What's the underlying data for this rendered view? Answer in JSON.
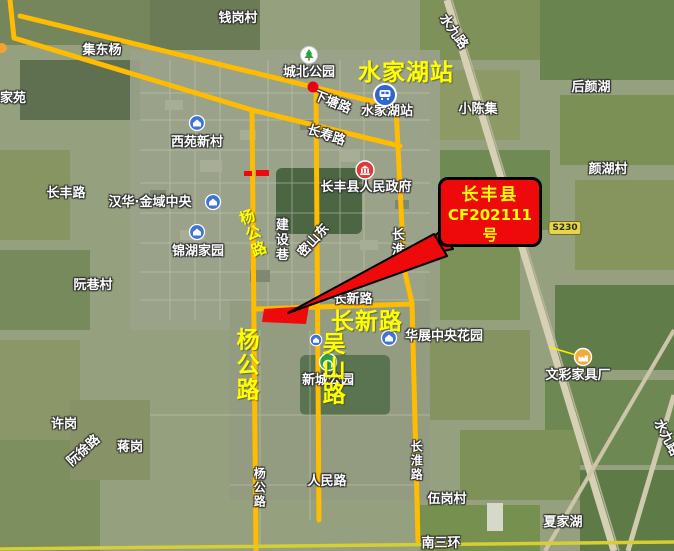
{
  "map": {
    "title": "长丰县 CF202111 号 地块示意图（水家湖卫星图）",
    "colors": {
      "overlay_road": "#ffbc00",
      "ring_road": "#d6ce33",
      "annotation_red": "#ee0a0a",
      "annotation_yellow": "#ffff00",
      "label_white": "#ffffff"
    },
    "overlay_roads": [
      {
        "name": "xiatang-road-overlay",
        "points": "20,16 313,87 396,107",
        "w": 5
      },
      {
        "name": "changshou-road-overlay",
        "points": "10,0 14,38 252,110 400,146",
        "w": 5
      },
      {
        "name": "changhuai-road-overlay",
        "points": "396,107 404,268 412,303 418,541",
        "w": 5
      },
      {
        "name": "yanggong-road-overlay",
        "points": "252,110 256,551",
        "w": 5
      },
      {
        "name": "wushan-road-overlay",
        "points": "316,90 319,520",
        "w": 5
      },
      {
        "name": "changxin-road-overlay",
        "points": "257,309 412,304",
        "w": 5
      },
      {
        "name": "south-third-ring-overlay",
        "points": "0,549 674,542",
        "w": 3.5,
        "color": "#d6ce33"
      }
    ],
    "white_labels": [
      {
        "t": "钱岗村",
        "x": 238,
        "y": 19
      },
      {
        "t": "集东杨",
        "x": 102,
        "y": 51
      },
      {
        "t": "家苑",
        "x": 13,
        "y": 99
      },
      {
        "t": "城北公园",
        "x": 309,
        "y": 73
      },
      {
        "t": "下塘路",
        "x": 332,
        "y": 103,
        "rot": 22
      },
      {
        "t": "水家湖站",
        "x": 387,
        "y": 112
      },
      {
        "t": "小陈集",
        "x": 478,
        "y": 110
      },
      {
        "t": "后颜湖",
        "x": 591,
        "y": 88
      },
      {
        "t": "颜湖村",
        "x": 608,
        "y": 170
      },
      {
        "t": "西苑新村",
        "x": 197,
        "y": 143
      },
      {
        "t": "长寿路",
        "x": 326,
        "y": 136,
        "rot": 18
      },
      {
        "t": "长丰路",
        "x": 66,
        "y": 194
      },
      {
        "t": "汉华·金域中央",
        "x": 150,
        "y": 203
      },
      {
        "t": "锦湖家园",
        "x": 198,
        "y": 252
      },
      {
        "t": "建设巷",
        "x": 280,
        "y": 240,
        "o": "v"
      },
      {
        "t": "密山东",
        "x": 314,
        "y": 241,
        "rot": -48
      },
      {
        "t": "长淮路",
        "x": 396,
        "y": 250,
        "o": "v"
      },
      {
        "t": "长丰县人民政府",
        "x": 366,
        "y": 188
      },
      {
        "t": "长新路",
        "x": 353,
        "y": 300
      },
      {
        "t": "华展中央花园",
        "x": 444,
        "y": 337
      },
      {
        "t": "新城公园",
        "x": 328,
        "y": 381
      },
      {
        "t": "文彩家具厂",
        "x": 578,
        "y": 376
      },
      {
        "t": "人民路",
        "x": 327,
        "y": 482
      },
      {
        "t": "杨公路",
        "x": 259,
        "y": 488,
        "o": "v",
        "size": 12
      },
      {
        "t": "长淮路",
        "x": 416,
        "y": 461,
        "o": "v",
        "size": 12
      },
      {
        "t": "伍岗村",
        "x": 447,
        "y": 500
      },
      {
        "t": "夏家湖",
        "x": 563,
        "y": 523
      },
      {
        "t": "南三环",
        "x": 441,
        "y": 544
      },
      {
        "t": "许岗",
        "x": 64,
        "y": 425
      },
      {
        "t": "阮徐路",
        "x": 84,
        "y": 451,
        "rot": -42
      },
      {
        "t": "蒋岗",
        "x": 130,
        "y": 448
      },
      {
        "t": "阮巷村",
        "x": 93,
        "y": 286
      },
      {
        "t": "水九路",
        "x": 453,
        "y": 32,
        "rot": 55
      },
      {
        "t": "水九路",
        "x": 666,
        "y": 438,
        "rot": 62
      }
    ],
    "yellow_labels": [
      {
        "t": "水家湖站",
        "x": 406,
        "y": 73,
        "size": 23
      },
      {
        "t": "长新路",
        "x": 367,
        "y": 322,
        "size": 23
      },
      {
        "t": "杨公路",
        "x": 245,
        "y": 365,
        "size": 23,
        "o": "v"
      },
      {
        "t": "吴山路",
        "x": 331,
        "y": 369,
        "size": 23,
        "o": "v"
      },
      {
        "t": "杨公路",
        "x": 252,
        "y": 234,
        "size": 15,
        "o": "v",
        "rot": -20
      }
    ],
    "pois": [
      {
        "name": "chengbei-park-icon",
        "type": "park-light",
        "x": 309,
        "y": 55
      },
      {
        "name": "metro-station-icon",
        "type": "metro",
        "x": 385,
        "y": 95
      },
      {
        "name": "government-icon",
        "type": "government",
        "x": 365,
        "y": 170
      },
      {
        "name": "xiyuan-xincun-icon",
        "type": "house",
        "x": 197,
        "y": 123
      },
      {
        "name": "hanhua-jinyu-icon",
        "type": "house",
        "x": 213,
        "y": 202
      },
      {
        "name": "jinhu-jiayuan-icon",
        "type": "house",
        "x": 197,
        "y": 232
      },
      {
        "name": "huazhan-huayuan-icon",
        "type": "house",
        "x": 389,
        "y": 338
      },
      {
        "name": "xincheng-poi-icon",
        "type": "house-small",
        "x": 316,
        "y": 340
      },
      {
        "name": "xincheng-park-icon",
        "type": "park-green",
        "x": 328,
        "y": 362
      },
      {
        "name": "wencai-factory-icon",
        "type": "factory",
        "x": 583,
        "y": 357
      }
    ],
    "road_shield": {
      "t": "S230",
      "x": 565,
      "y": 228
    },
    "annotations": {
      "callout": {
        "lines": [
          "长丰县",
          "CF202111",
          "号"
        ]
      },
      "arrow_points": "288,313 434,234 447,256",
      "tail_points": "440,231 412,257 453,249",
      "parcel_points": "264,309 309,306 306,324 262,322",
      "red_dot": {
        "x": 313,
        "y": 87,
        "r": 5.5
      },
      "red_dashes": [
        {
          "x": 244,
          "y": 171,
          "w": 8,
          "h": 5
        },
        {
          "x": 256,
          "y": 170,
          "w": 13,
          "h": 6
        }
      ],
      "factory_pointer": {
        "x1": 549,
        "y1": 347,
        "x2": 576,
        "y2": 355
      }
    }
  }
}
